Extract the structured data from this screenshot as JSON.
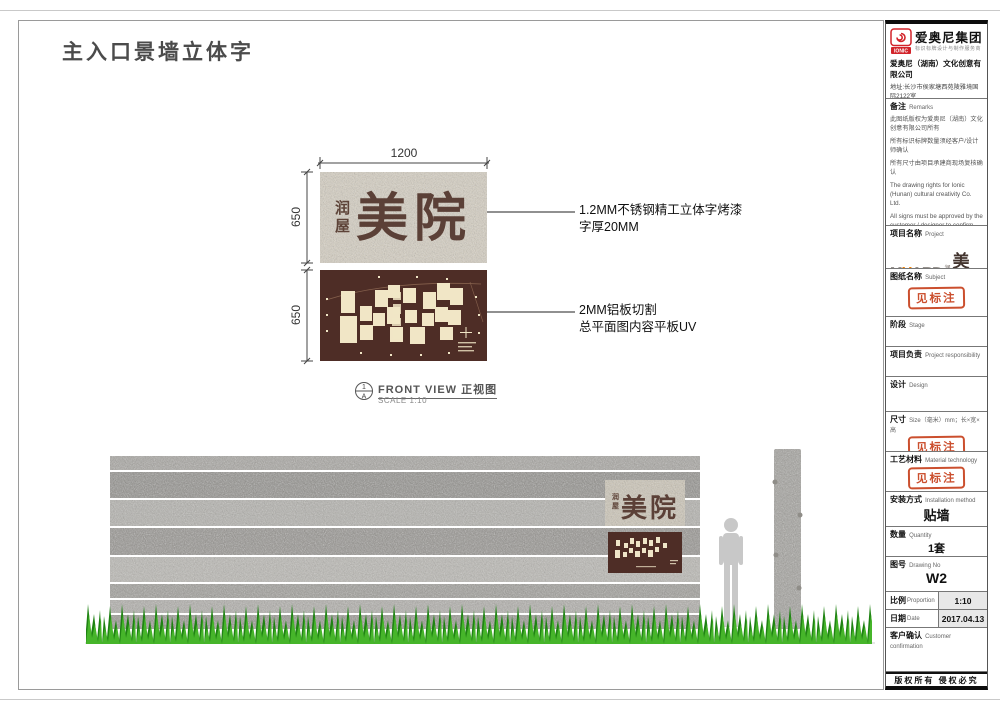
{
  "page": {
    "title": "主入口景墙立体字"
  },
  "detail": {
    "dim_width": "1200",
    "dim_height": "650",
    "dim_height2": "650",
    "sign": {
      "prefix1": "润",
      "prefix2": "屋",
      "main": "美院"
    },
    "ann1_l1": "1.2MM不锈钢精工立体字烤漆",
    "ann1_l2": "字厚20MM",
    "ann2_l1": "2MM铝板切割",
    "ann2_l2": "总平面图内容平板UV",
    "view_label": "FRONT VIEW 正视图",
    "view_scale": "SCALE 1:10",
    "sym_top": "1",
    "sym_bottom": "A"
  },
  "titleblock": {
    "brand": {
      "logo_text": "IONIC",
      "group": "爱奥尼集团",
      "tagline": "标识标牌设计与制作服务商",
      "company": "爱奥尼（湖南）文化创意有限公司",
      "address": "地址:长沙市侯家塘西苑陵雅境国际2122室",
      "phone": "电话:0731-85074045",
      "site": "http://www.ionic.net.cn"
    },
    "remarks": {
      "cn": "备注",
      "en": "Remarks",
      "p1": "此图纸版权为爱奥尼（湖南）文化创意有限公司所有",
      "p2": "所有标识标牌数量须经客户/设计师确认",
      "p3": "所有尺寸由项目承建商现场复核确认",
      "p4": "The drawing rights for Ionic (Hunan) cultural creativity Co. Ltd.",
      "p5": "All signs must be approved by the customer / designer to confirm the number of",
      "p6": "All dimensions by the project contractors on-site review confirmed"
    },
    "myard": {
      "m": "M",
      "y": "Y",
      "ard": "ARD",
      "s1": "润",
      "s2": "屋",
      "cn": "美院"
    },
    "stamp": "见标注",
    "sections": {
      "project": {
        "cn": "项目名称",
        "en": "Project"
      },
      "subject": {
        "cn": "图纸名称",
        "en": "Subject"
      },
      "stage": {
        "cn": "阶段",
        "en": "Stage"
      },
      "responsibility": {
        "cn": "项目负责",
        "en": "Project responsibility"
      },
      "design": {
        "cn": "设计",
        "en": "Design"
      },
      "size": {
        "cn": "尺寸",
        "en": "Size（毫米）mm；长×宽×高"
      },
      "material": {
        "cn": "工艺材料",
        "en": "Material technology"
      },
      "install": {
        "cn": "安装方式",
        "en": "Installation method",
        "value": "贴墙"
      },
      "quantity": {
        "cn": "数量",
        "en": "Quantity",
        "value": "1套"
      },
      "drawing_no": {
        "cn": "图号",
        "en": "Drawing No",
        "value": "W2"
      },
      "proportion": {
        "cn": "比例",
        "en": "Proportion",
        "value": "1:10"
      },
      "date": {
        "cn": "日期",
        "en": "Date",
        "value": "2017.04.13"
      },
      "customer": {
        "cn": "客户确认",
        "en": "Customer confirmation"
      }
    },
    "footer": "版权所有 侵权必究"
  }
}
